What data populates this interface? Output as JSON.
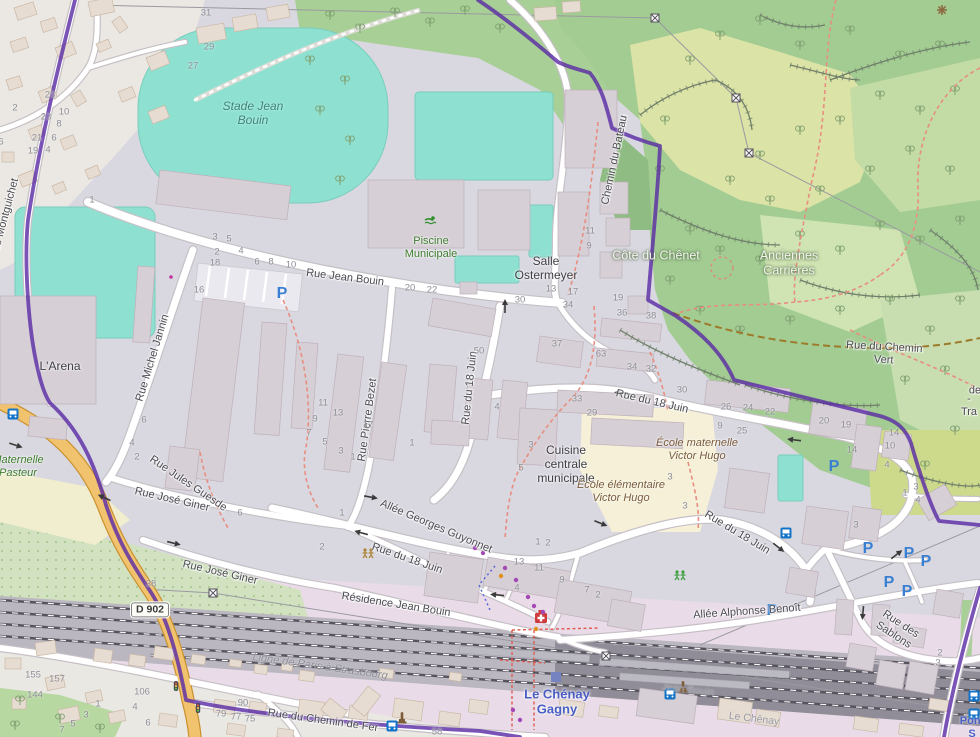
{
  "map": {
    "title": "Le Chénay Gagny",
    "boundary_color": "#5b2da5",
    "place_labels": [
      {
        "name": "stade-jean-bouin",
        "text": "Stade Jean\nBouin",
        "x": 253,
        "y": 113,
        "rot": 0,
        "cls": "teal"
      },
      {
        "name": "piscine-municipale",
        "text": "Piscine\nMunicipale",
        "x": 431,
        "y": 248,
        "rot": 0,
        "cls": "green"
      },
      {
        "name": "salle-ostermeyer",
        "text": "Salle\nOstermeyer",
        "x": 546,
        "y": 268,
        "rot": 0,
        "cls": "place"
      },
      {
        "name": "l-arena",
        "text": "L'Arena",
        "x": 60,
        "y": 366,
        "rot": 0,
        "cls": "place"
      },
      {
        "name": "cuisine-centrale",
        "text": "Cuisine\ncentrale\nmunicipale",
        "x": 566,
        "y": 464,
        "rot": 0,
        "cls": "place"
      },
      {
        "name": "ecole-maternelle-victor-hugo",
        "text": "École maternelle\nVictor Hugo",
        "x": 697,
        "y": 450,
        "rot": 0,
        "cls": "school"
      },
      {
        "name": "ecole-elementaire-victor-hugo",
        "text": "École élémentaire\nVictor Hugo",
        "x": 621,
        "y": 492,
        "rot": 0,
        "cls": "school"
      },
      {
        "name": "maternelle-pasteur",
        "text": "Maternelle\nPasteur",
        "x": 18,
        "y": 467,
        "rot": 0,
        "cls": "green-i"
      },
      {
        "name": "cote-du-chenet",
        "text": "Côte du Chênet",
        "x": 656,
        "y": 256,
        "rot": 0,
        "cls": "white"
      },
      {
        "name": "anciennes-carrieres",
        "text": "Anciennes\nCarrières",
        "x": 789,
        "y": 263,
        "rot": 0,
        "cls": "white"
      },
      {
        "name": "station-le-chenay-gagny",
        "text": "Le Chénay\nGagny",
        "x": 557,
        "y": 702,
        "rot": 0,
        "cls": "blue"
      },
      {
        "name": "pont-label",
        "text": "Pont S",
        "x": 972,
        "y": 728,
        "rot": 0,
        "cls": "blue-sm"
      }
    ],
    "street_labels": [
      {
        "name": "rue-jean-bouin",
        "text": "Rue Jean Bouin",
        "x": 345,
        "y": 278,
        "rot": 7
      },
      {
        "name": "rue-michel-jannin",
        "text": "Rue Michel Jannin",
        "x": 153,
        "y": 358,
        "rot": -73
      },
      {
        "name": "montguichet",
        "text": "de Montguichet",
        "x": 6,
        "y": 215,
        "rot": -75
      },
      {
        "name": "rue-jules-guesde",
        "text": "Rue Jules Guesde",
        "x": 188,
        "y": 484,
        "rot": 34
      },
      {
        "name": "rue-jose-giner-1",
        "text": "Rue José Giner",
        "x": 172,
        "y": 500,
        "rot": 13
      },
      {
        "name": "rue-jose-giner-2",
        "text": "Rue José Giner",
        "x": 220,
        "y": 573,
        "rot": 13
      },
      {
        "name": "rue-pierre-bezet",
        "text": "Rue Pierre Bezet",
        "x": 368,
        "y": 420,
        "rot": -82
      },
      {
        "name": "allee-georges-guyonnet",
        "text": "Allée Georges Guyonnet",
        "x": 436,
        "y": 527,
        "rot": 23
      },
      {
        "name": "rue-du-18-juin-v",
        "text": "Rue du 18 Juin",
        "x": 470,
        "y": 388,
        "rot": -84
      },
      {
        "name": "rue-du-18-juin-n",
        "text": "Rue du 18 Juin",
        "x": 652,
        "y": 402,
        "rot": 13
      },
      {
        "name": "rue-du-18-juin-c",
        "text": "Rue du 18 Juin",
        "x": 737,
        "y": 533,
        "rot": 31
      },
      {
        "name": "rue-du-18-juin-w",
        "text": "Rue du 18 Juin",
        "x": 407,
        "y": 559,
        "rot": 19
      },
      {
        "name": "residence-jean-bouin",
        "text": "Résidence Jean Bouin",
        "x": 396,
        "y": 605,
        "rot": 9
      },
      {
        "name": "allee-alphonse-benoit",
        "text": "Allée Alphonse Benoît",
        "x": 747,
        "y": 612,
        "rot": -4
      },
      {
        "name": "rue-des-sablons",
        "text": "Rue des Sablons",
        "x": 897,
        "y": 630,
        "rot": 33
      },
      {
        "name": "rue-du-chemin-de-fer",
        "text": "Rue du Chemin de Fer",
        "x": 323,
        "y": 721,
        "rot": 8
      },
      {
        "name": "chemin-du-bateau",
        "text": "Chemin du Bateau",
        "x": 615,
        "y": 160,
        "rot": -78
      },
      {
        "name": "rue-du-chemin-vert",
        "text": "Rue du Chemin Vert",
        "x": 884,
        "y": 354,
        "rot": 3
      },
      {
        "name": "ligne-paris-strasbourg",
        "text": "Ligne de Paris à Strasbourg",
        "x": 320,
        "y": 667,
        "rot": 8,
        "cls": "railname"
      },
      {
        "name": "rail-jean-bouin",
        "text": "Jean Bouin",
        "x": 688,
        "y": 690,
        "rot": 7,
        "cls": "rail2"
      },
      {
        "name": "rail-le-chenay",
        "text": "Le Chênay",
        "x": 754,
        "y": 719,
        "rot": 7,
        "cls": "rail2"
      },
      {
        "name": "edge-text-de",
        "text": "de",
        "x": 975,
        "y": 391,
        "rot": 0
      },
      {
        "name": "edge-text-tra",
        "text": "- Tra",
        "x": 969,
        "y": 406,
        "rot": 0
      }
    ],
    "road_shield": {
      "text": "D 902",
      "x": 150,
      "y": 610
    },
    "house_numbers": [
      {
        "t": "31",
        "x": 206,
        "y": 13
      },
      {
        "t": "29",
        "x": 209,
        "y": 47
      },
      {
        "t": "27",
        "x": 193,
        "y": 66
      },
      {
        "t": "25",
        "x": 50,
        "y": 95
      },
      {
        "t": "23",
        "x": 46,
        "y": 117
      },
      {
        "t": "21",
        "x": 37,
        "y": 138
      },
      {
        "t": "19",
        "x": 33,
        "y": 151
      },
      {
        "t": "2",
        "x": 15,
        "y": 108
      },
      {
        "t": "10",
        "x": 64,
        "y": 112
      },
      {
        "t": "8",
        "x": 59,
        "y": 124
      },
      {
        "t": "6",
        "x": 54,
        "y": 138
      },
      {
        "t": "4",
        "x": 48,
        "y": 150
      },
      {
        "t": "6",
        "x": 1,
        "y": 142
      },
      {
        "t": "1",
        "x": 92,
        "y": 200
      },
      {
        "t": "3",
        "x": 215,
        "y": 237
      },
      {
        "t": "5",
        "x": 229,
        "y": 239
      },
      {
        "t": "2",
        "x": 217,
        "y": 252
      },
      {
        "t": "4",
        "x": 241,
        "y": 251
      },
      {
        "t": "6",
        "x": 257,
        "y": 262
      },
      {
        "t": "8",
        "x": 271,
        "y": 262
      },
      {
        "t": "10",
        "x": 291,
        "y": 265
      },
      {
        "t": "18",
        "x": 215,
        "y": 263
      },
      {
        "t": "16",
        "x": 199,
        "y": 290
      },
      {
        "t": "20",
        "x": 410,
        "y": 288
      },
      {
        "t": "22",
        "x": 432,
        "y": 290
      },
      {
        "t": "13",
        "x": 551,
        "y": 289
      },
      {
        "t": "17",
        "x": 573,
        "y": 292
      },
      {
        "t": "30",
        "x": 520,
        "y": 300
      },
      {
        "t": "34",
        "x": 568,
        "y": 305
      },
      {
        "t": "19",
        "x": 618,
        "y": 298
      },
      {
        "t": "36",
        "x": 622,
        "y": 313
      },
      {
        "t": "38",
        "x": 651,
        "y": 316
      },
      {
        "t": "11",
        "x": 590,
        "y": 231
      },
      {
        "t": "9",
        "x": 589,
        "y": 246
      },
      {
        "t": "50",
        "x": 479,
        "y": 351
      },
      {
        "t": "37",
        "x": 557,
        "y": 344
      },
      {
        "t": "63",
        "x": 601,
        "y": 354
      },
      {
        "t": "33",
        "x": 577,
        "y": 399
      },
      {
        "t": "29",
        "x": 592,
        "y": 413
      },
      {
        "t": "34",
        "x": 632,
        "y": 367
      },
      {
        "t": "32",
        "x": 651,
        "y": 369
      },
      {
        "t": "30",
        "x": 682,
        "y": 390
      },
      {
        "t": "26",
        "x": 726,
        "y": 407
      },
      {
        "t": "24",
        "x": 748,
        "y": 408
      },
      {
        "t": "22",
        "x": 770,
        "y": 412
      },
      {
        "t": "20",
        "x": 824,
        "y": 421
      },
      {
        "t": "19",
        "x": 846,
        "y": 425
      },
      {
        "t": "9",
        "x": 720,
        "y": 426
      },
      {
        "t": "25",
        "x": 742,
        "y": 431
      },
      {
        "t": "14",
        "x": 852,
        "y": 450
      },
      {
        "t": "14",
        "x": 894,
        "y": 433
      },
      {
        "t": "10",
        "x": 890,
        "y": 446
      },
      {
        "t": "4",
        "x": 887,
        "y": 465
      },
      {
        "t": "1",
        "x": 905,
        "y": 493
      },
      {
        "t": "3",
        "x": 916,
        "y": 487
      },
      {
        "t": "4",
        "x": 918,
        "y": 500
      },
      {
        "t": "3",
        "x": 856,
        "y": 525
      },
      {
        "t": "3",
        "x": 685,
        "y": 506
      },
      {
        "t": "3",
        "x": 670,
        "y": 477
      },
      {
        "t": "3",
        "x": 531,
        "y": 445
      },
      {
        "t": "5",
        "x": 521,
        "y": 468
      },
      {
        "t": "11",
        "x": 323,
        "y": 403
      },
      {
        "t": "13",
        "x": 338,
        "y": 413
      },
      {
        "t": "9",
        "x": 315,
        "y": 419
      },
      {
        "t": "7",
        "x": 309,
        "y": 433
      },
      {
        "t": "5",
        "x": 325,
        "y": 442
      },
      {
        "t": "3",
        "x": 341,
        "y": 451
      },
      {
        "t": "1",
        "x": 353,
        "y": 457
      },
      {
        "t": "17",
        "x": 368,
        "y": 425
      },
      {
        "t": "1",
        "x": 412,
        "y": 443
      },
      {
        "t": "4",
        "x": 497,
        "y": 407
      },
      {
        "t": "1",
        "x": 342,
        "y": 513
      },
      {
        "t": "2",
        "x": 322,
        "y": 547
      },
      {
        "t": "6",
        "x": 144,
        "y": 420
      },
      {
        "t": "4",
        "x": 132,
        "y": 443
      },
      {
        "t": "2",
        "x": 137,
        "y": 457
      },
      {
        "t": "6",
        "x": 240,
        "y": 513
      },
      {
        "t": "13",
        "x": 519,
        "y": 562
      },
      {
        "t": "11",
        "x": 539,
        "y": 568
      },
      {
        "t": "9",
        "x": 562,
        "y": 580
      },
      {
        "t": "7",
        "x": 587,
        "y": 590
      },
      {
        "t": "2",
        "x": 598,
        "y": 595
      },
      {
        "t": "4",
        "x": 517,
        "y": 588
      },
      {
        "t": "1",
        "x": 538,
        "y": 542
      },
      {
        "t": "2",
        "x": 548,
        "y": 543
      },
      {
        "t": "2",
        "x": 940,
        "y": 653
      },
      {
        "t": "3",
        "x": 938,
        "y": 663
      },
      {
        "t": "155",
        "x": 33,
        "y": 675
      },
      {
        "t": "157",
        "x": 57,
        "y": 679
      },
      {
        "t": "144",
        "x": 35,
        "y": 695
      },
      {
        "t": "106",
        "x": 142,
        "y": 692
      },
      {
        "t": "1",
        "x": 98,
        "y": 704
      },
      {
        "t": "3",
        "x": 86,
        "y": 715
      },
      {
        "t": "4",
        "x": 135,
        "y": 707
      },
      {
        "t": "5",
        "x": 73,
        "y": 724
      },
      {
        "t": "6",
        "x": 148,
        "y": 723
      },
      {
        "t": "7",
        "x": 62,
        "y": 730
      },
      {
        "t": "79",
        "x": 221,
        "y": 714
      },
      {
        "t": "77",
        "x": 236,
        "y": 717
      },
      {
        "t": "75",
        "x": 250,
        "y": 719
      },
      {
        "t": "90",
        "x": 243,
        "y": 703
      },
      {
        "t": "38",
        "x": 151,
        "y": 584
      },
      {
        "t": "58",
        "x": 437,
        "y": 732
      }
    ],
    "icons": [
      {
        "type": "parking",
        "x": 282,
        "y": 293
      },
      {
        "type": "parking",
        "x": 834,
        "y": 466
      },
      {
        "type": "parking",
        "x": 868,
        "y": 548
      },
      {
        "type": "parking",
        "x": 909,
        "y": 553
      },
      {
        "type": "parking",
        "x": 926,
        "y": 561
      },
      {
        "type": "parking",
        "x": 889,
        "y": 582
      },
      {
        "type": "parking",
        "x": 907,
        "y": 591
      },
      {
        "type": "parking",
        "x": 772,
        "y": 610
      },
      {
        "type": "bus",
        "x": 13,
        "y": 414
      },
      {
        "type": "bus",
        "x": 786,
        "y": 533
      },
      {
        "type": "bus",
        "x": 670,
        "y": 694
      },
      {
        "type": "bus",
        "x": 392,
        "y": 726
      },
      {
        "type": "bus",
        "x": 974,
        "y": 696
      },
      {
        "type": "bus",
        "x": 974,
        "y": 714
      },
      {
        "type": "pharmacy",
        "x": 541,
        "y": 617
      },
      {
        "type": "monument",
        "x": 683,
        "y": 688
      },
      {
        "type": "monument",
        "x": 402,
        "y": 719
      },
      {
        "type": "playground",
        "x": 680,
        "y": 575
      },
      {
        "type": "childcare",
        "x": 368,
        "y": 553
      },
      {
        "type": "swimmer",
        "x": 430,
        "y": 221
      },
      {
        "type": "viewpoint",
        "x": 942,
        "y": 10
      },
      {
        "type": "pylon",
        "x": 655,
        "y": 18
      },
      {
        "type": "pylon",
        "x": 736,
        "y": 98
      },
      {
        "type": "pylon",
        "x": 749,
        "y": 153
      },
      {
        "type": "pylon",
        "x": 213,
        "y": 593
      },
      {
        "type": "pylon",
        "x": 606,
        "y": 656
      },
      {
        "type": "traffic-light",
        "x": 176,
        "y": 686
      },
      {
        "type": "traffic-light",
        "x": 198,
        "y": 708
      },
      {
        "type": "station-square",
        "x": 556,
        "y": 677
      },
      {
        "type": "dot-purple",
        "x": 475,
        "y": 548
      },
      {
        "type": "dot-purple",
        "x": 483,
        "y": 553
      },
      {
        "type": "dot-purple",
        "x": 505,
        "y": 568
      },
      {
        "type": "dot-purple",
        "x": 516,
        "y": 580
      },
      {
        "type": "dot-purple",
        "x": 528,
        "y": 597
      },
      {
        "type": "dot-purple",
        "x": 534,
        "y": 606
      },
      {
        "type": "dot-purple",
        "x": 543,
        "y": 612
      },
      {
        "type": "dot-purple",
        "x": 513,
        "y": 710
      },
      {
        "type": "dot-purple",
        "x": 520,
        "y": 720
      },
      {
        "type": "dot-orange",
        "x": 501,
        "y": 576
      },
      {
        "type": "dot-orange",
        "x": 536,
        "y": 629
      },
      {
        "type": "dot-magenta",
        "x": 171,
        "y": 277
      },
      {
        "type": "arrow",
        "x": 505,
        "y": 307,
        "rot": -90
      },
      {
        "type": "arrow",
        "x": 622,
        "y": 393,
        "rot": 185
      },
      {
        "type": "arrow",
        "x": 795,
        "y": 440,
        "rot": 187
      },
      {
        "type": "arrow",
        "x": 600,
        "y": 523,
        "rot": 22
      },
      {
        "type": "arrow",
        "x": 778,
        "y": 547,
        "rot": 38
      },
      {
        "type": "arrow",
        "x": 370,
        "y": 497,
        "rot": 10
      },
      {
        "type": "arrow",
        "x": 362,
        "y": 533,
        "rot": 195
      },
      {
        "type": "arrow",
        "x": 15,
        "y": 445,
        "rot": 18
      },
      {
        "type": "arrow",
        "x": 105,
        "y": 498,
        "rot": 205
      },
      {
        "type": "arrow",
        "x": 173,
        "y": 543,
        "rot": 14
      },
      {
        "type": "arrow",
        "x": 863,
        "y": 612,
        "rot": 95
      },
      {
        "type": "arrow",
        "x": 896,
        "y": 555,
        "rot": -38
      },
      {
        "type": "arrow",
        "x": 498,
        "y": 595,
        "rot": 185
      }
    ],
    "colors": {
      "urban": "#d9d8e0",
      "forest": "#a3cc93",
      "heath": "#dce3a6",
      "pitch": "#8ee1d1",
      "primary_road": "#f2c36e",
      "boundary": "#5b2da5",
      "rail_land": "#e9dce8",
      "school": "#f5f0d7",
      "parking_blue": "#3a80d2",
      "station_blue": "#4a5ec4",
      "path_red": "#e88e80",
      "track_brown": "#9c7a2a"
    }
  }
}
